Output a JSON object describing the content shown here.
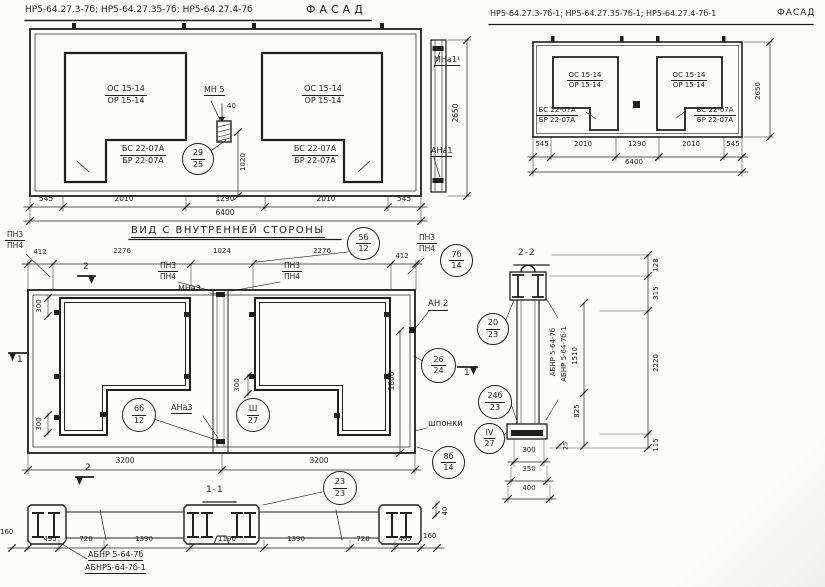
{
  "common": {
    "window_top": "ОС 15-14",
    "window_bottom": "ОР 15-14",
    "sill_top": "БС 22-07А",
    "sill_bottom": "БР 22-07А",
    "dim_total": "6400",
    "dim_height": "2650",
    "dims": [
      "545",
      "2010",
      "1290",
      "2010",
      "545"
    ]
  },
  "facade_left": {
    "title_codes": "НР5-64.27.3-7б; НР5-64.27.35-7б; НР5-64.27.4-7б",
    "title_view": "ФАСАД",
    "detail_label": "МН 5",
    "detail_width": "40",
    "detail_height": "1020",
    "circle_29": {
      "t": "29",
      "b": "25"
    },
    "mark_top": "МНа1¹",
    "mark_bottom": "АНа1"
  },
  "facade_right": {
    "title_codes": "НР5-64.27.3-7б-1; НР5-64.27.35-7б-1; НР5-64.27.4-7б-1",
    "title_view": "ФАСАД"
  },
  "inner_view": {
    "title": "ВИД С ВНУТРЕННЕЙ СТОРОНЫ",
    "pn3": "ПН3",
    "pn4": "ПН4",
    "dims_top": [
      "412",
      "2276",
      "1024",
      "2276",
      "412"
    ],
    "dims_bottom": [
      "3200",
      "3200"
    ],
    "dim_300": "300",
    "dim_1800": "1800",
    "mna3": "МНа3",
    "ana3": "АНа3",
    "an2": "АН 2",
    "shponki": "шпонки",
    "sec1": "1",
    "sec2": "2",
    "c5b": {
      "t": "5б",
      "b": "12"
    },
    "c7b": {
      "t": "7б",
      "b": "14"
    },
    "c6b": {
      "t": "6б",
      "b": "12"
    },
    "csh": {
      "t": "Ш",
      "b": "27"
    },
    "c20": {
      "t": "20",
      "b": "23"
    },
    "c26": {
      "t": "26",
      "b": "24"
    },
    "c24b": {
      "t": "24б",
      "b": "23"
    },
    "civ": {
      "t": "IV",
      "b": "27"
    },
    "c8b": {
      "t": "8б",
      "b": "14"
    }
  },
  "section_1_1": {
    "title": "1-1",
    "c23": {
      "t": "23",
      "b": "23"
    },
    "dims": [
      "495",
      "720",
      "1390",
      "1190",
      "1390",
      "720",
      "495"
    ],
    "dim_160": "160",
    "dim_40": "40",
    "label_1": "АБНР 5-64-7б",
    "label_2": "АБНР5-64-7б-1"
  },
  "section_2_2": {
    "title": "2-2",
    "label_1": "АБНР 5-64-7б",
    "label_2": "АБНР 5-64-7б-1",
    "dim_1510": "1510",
    "dim_825": "825",
    "dim_128": "128",
    "dim_315": "315",
    "dim_2220": "2220",
    "dim_115": "115",
    "dim_25": "25",
    "dims_bottom": [
      "300",
      "350",
      "400"
    ]
  }
}
